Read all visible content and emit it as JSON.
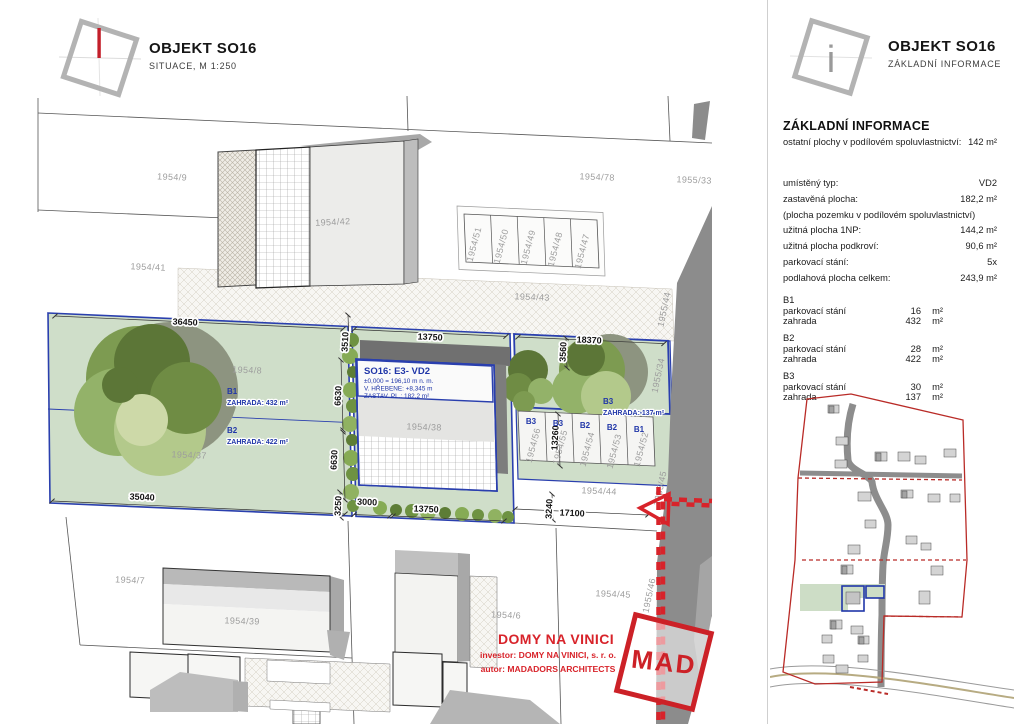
{
  "left_header": {
    "title": "OBJEKT SO16",
    "subtitle": "SITUACE, M 1:250"
  },
  "right_header": {
    "title": "OBJEKT SO16",
    "subtitle": "ZÁKLADNÍ INFORMACE",
    "icon_letter": "i"
  },
  "info": {
    "heading": "ZÁKLADNÍ INFORMACE",
    "shared_label": "ostatní plochy v podílovém spoluvlastnictví:",
    "shared_value": "142 m²",
    "rows": [
      {
        "label": "umístěný typ:",
        "value": "VD2"
      },
      {
        "label": "zastavěná plocha:",
        "value": "182,2 m²"
      },
      {
        "label": "(plocha pozemku v podílovém spoluvlastnictví)",
        "value": ""
      },
      {
        "label": "užitná plocha 1NP:",
        "value": "144,2 m²"
      },
      {
        "label": "užitná plocha podkroví:",
        "value": "90,6 m²"
      },
      {
        "label": "parkovací stání:",
        "value": "5x"
      },
      {
        "label": "podlahová plocha celkem:",
        "value": "243,9 m²"
      }
    ],
    "units": [
      {
        "name": "B1",
        "rows": [
          {
            "label": "parkovací stání",
            "value": "16",
            "unit": "m²"
          },
          {
            "label": "zahrada",
            "value": "432",
            "unit": "m²"
          }
        ]
      },
      {
        "name": "B2",
        "rows": [
          {
            "label": "parkovací stání",
            "value": "28",
            "unit": "m²"
          },
          {
            "label": "zahrada",
            "value": "422",
            "unit": "m²"
          }
        ]
      },
      {
        "name": "B3",
        "rows": [
          {
            "label": "parkovací stání",
            "value": "30",
            "unit": "m²"
          },
          {
            "label": "zahrada",
            "value": "137",
            "unit": "m²"
          }
        ]
      }
    ]
  },
  "plan": {
    "labels": {
      "p9": "1954/9",
      "p41": "1954/41",
      "p42": "1954/42",
      "p78": "1954/78",
      "p33": "1955/33",
      "p51": "1954/51",
      "p50": "1954/50",
      "p49": "1954/49",
      "p48": "1954/48",
      "p47": "1954/47",
      "p43": "1954/43",
      "p44r": "1955/44",
      "p8": "1954/8",
      "p37": "1954/37",
      "p38": "1954/38",
      "p34": "1955/34",
      "p56": "1954/56",
      "p55": "1954/55",
      "p54": "1954/54",
      "p53": "1954/53",
      "p52": "1954/52",
      "p44": "1954/44",
      "p45r": "1955/45",
      "p7": "1954/7",
      "p39": "1954/39",
      "p45": "1954/45",
      "p6": "1954/6",
      "p46r": "1955/46"
    },
    "dims": {
      "d36450": "36450",
      "d35040": "35040",
      "d3510": "3510",
      "d13750a": "13750",
      "d13750b": "13750",
      "d18370": "18370",
      "d3560": "3560",
      "d6630a": "6630",
      "d6630b": "6630",
      "d3250": "3250",
      "d3000": "3000",
      "d13260": "13260",
      "d3240": "3240",
      "d17100": "17100"
    },
    "zones": {
      "b1": "B1",
      "b1_area": "ZAHRADA: 432 m²",
      "b2": "B2",
      "b2_area": "ZAHRADA: 422 m²",
      "b3": "B3",
      "b3_area": "ZAHRADA: 137 m²",
      "s1": "B3",
      "s2": "B3",
      "s3": "B2",
      "s4": "B2",
      "s5": "B1"
    },
    "building": {
      "title": "SO16: E3- VD2",
      "line1": "±0,000 = 196,10 m n. m.",
      "line2": "V. HŘEBENE: +8,345 m",
      "line3": "ZASTAV. PL.: 182,2 m²"
    },
    "footer": {
      "project": "DOMY NA VINICI",
      "investor": "investor: DOMY NA VINICI, s. r. o.",
      "author": "autor: MADADORS ARCHITECTS",
      "stamp": "MAD"
    }
  },
  "colors": {
    "accent_red": "#d8232a",
    "plan_blue": "#2036a8",
    "garden_green": "#cfdec9",
    "road_gray": "#8c8c8c"
  }
}
